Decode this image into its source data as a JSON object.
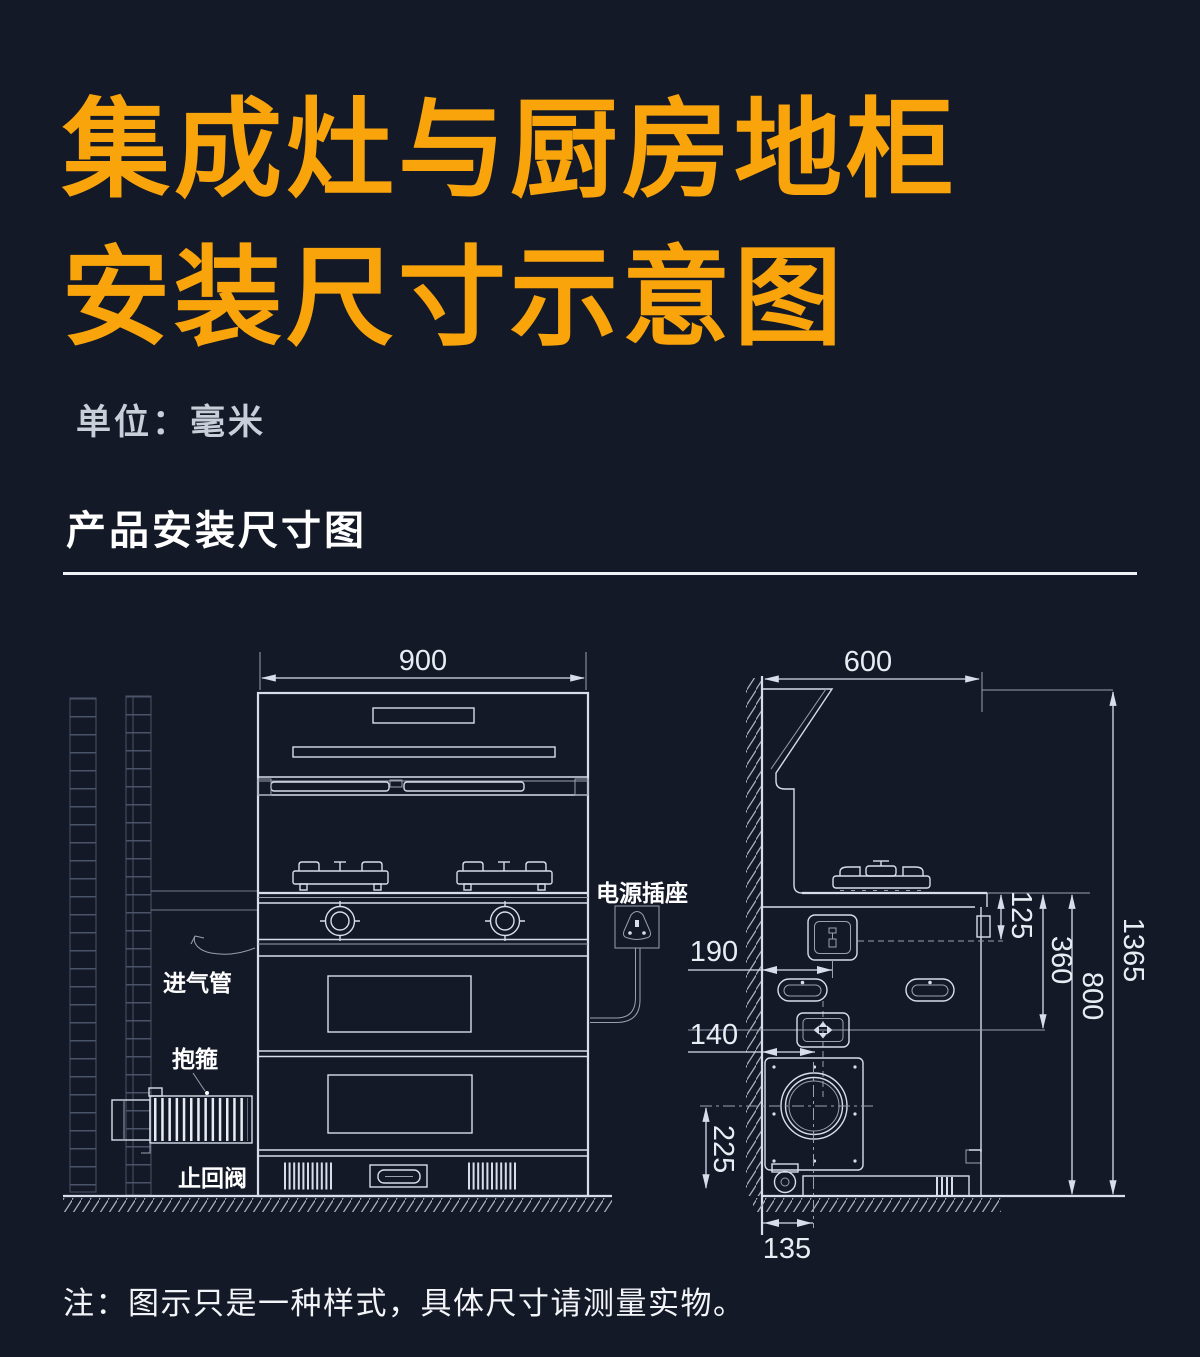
{
  "colors": {
    "background": "#141927",
    "accent_orange": "#F9A40B",
    "line_art": "#d7deea",
    "label_white": "#ffffff",
    "muted_gray": "#c9cfd8"
  },
  "header": {
    "title_line1": "集成灶与厨房地柜",
    "title_line2": "安装尺寸示意图",
    "unit_label": "单位：毫米",
    "section_title": "产品安装尺寸图"
  },
  "diagram": {
    "front_view": {
      "width_dim": "900",
      "air_inlet_label": "进气管",
      "clamp_label": "抱箍",
      "check_valve_label": "止回阀"
    },
    "power_socket_label": "电源插座",
    "side_view": {
      "depth_dim": "600",
      "dim_125": "125",
      "dim_360": "360",
      "counter_height_dim": "800",
      "total_height_dim": "1365",
      "socket_distance_dim": "190",
      "valve_distance_dim": "140",
      "fan_center_height_dim": "225",
      "fan_center_distance_dim": "135"
    }
  },
  "footnote": "注：图示只是一种样式，具体尺寸请测量实物。"
}
